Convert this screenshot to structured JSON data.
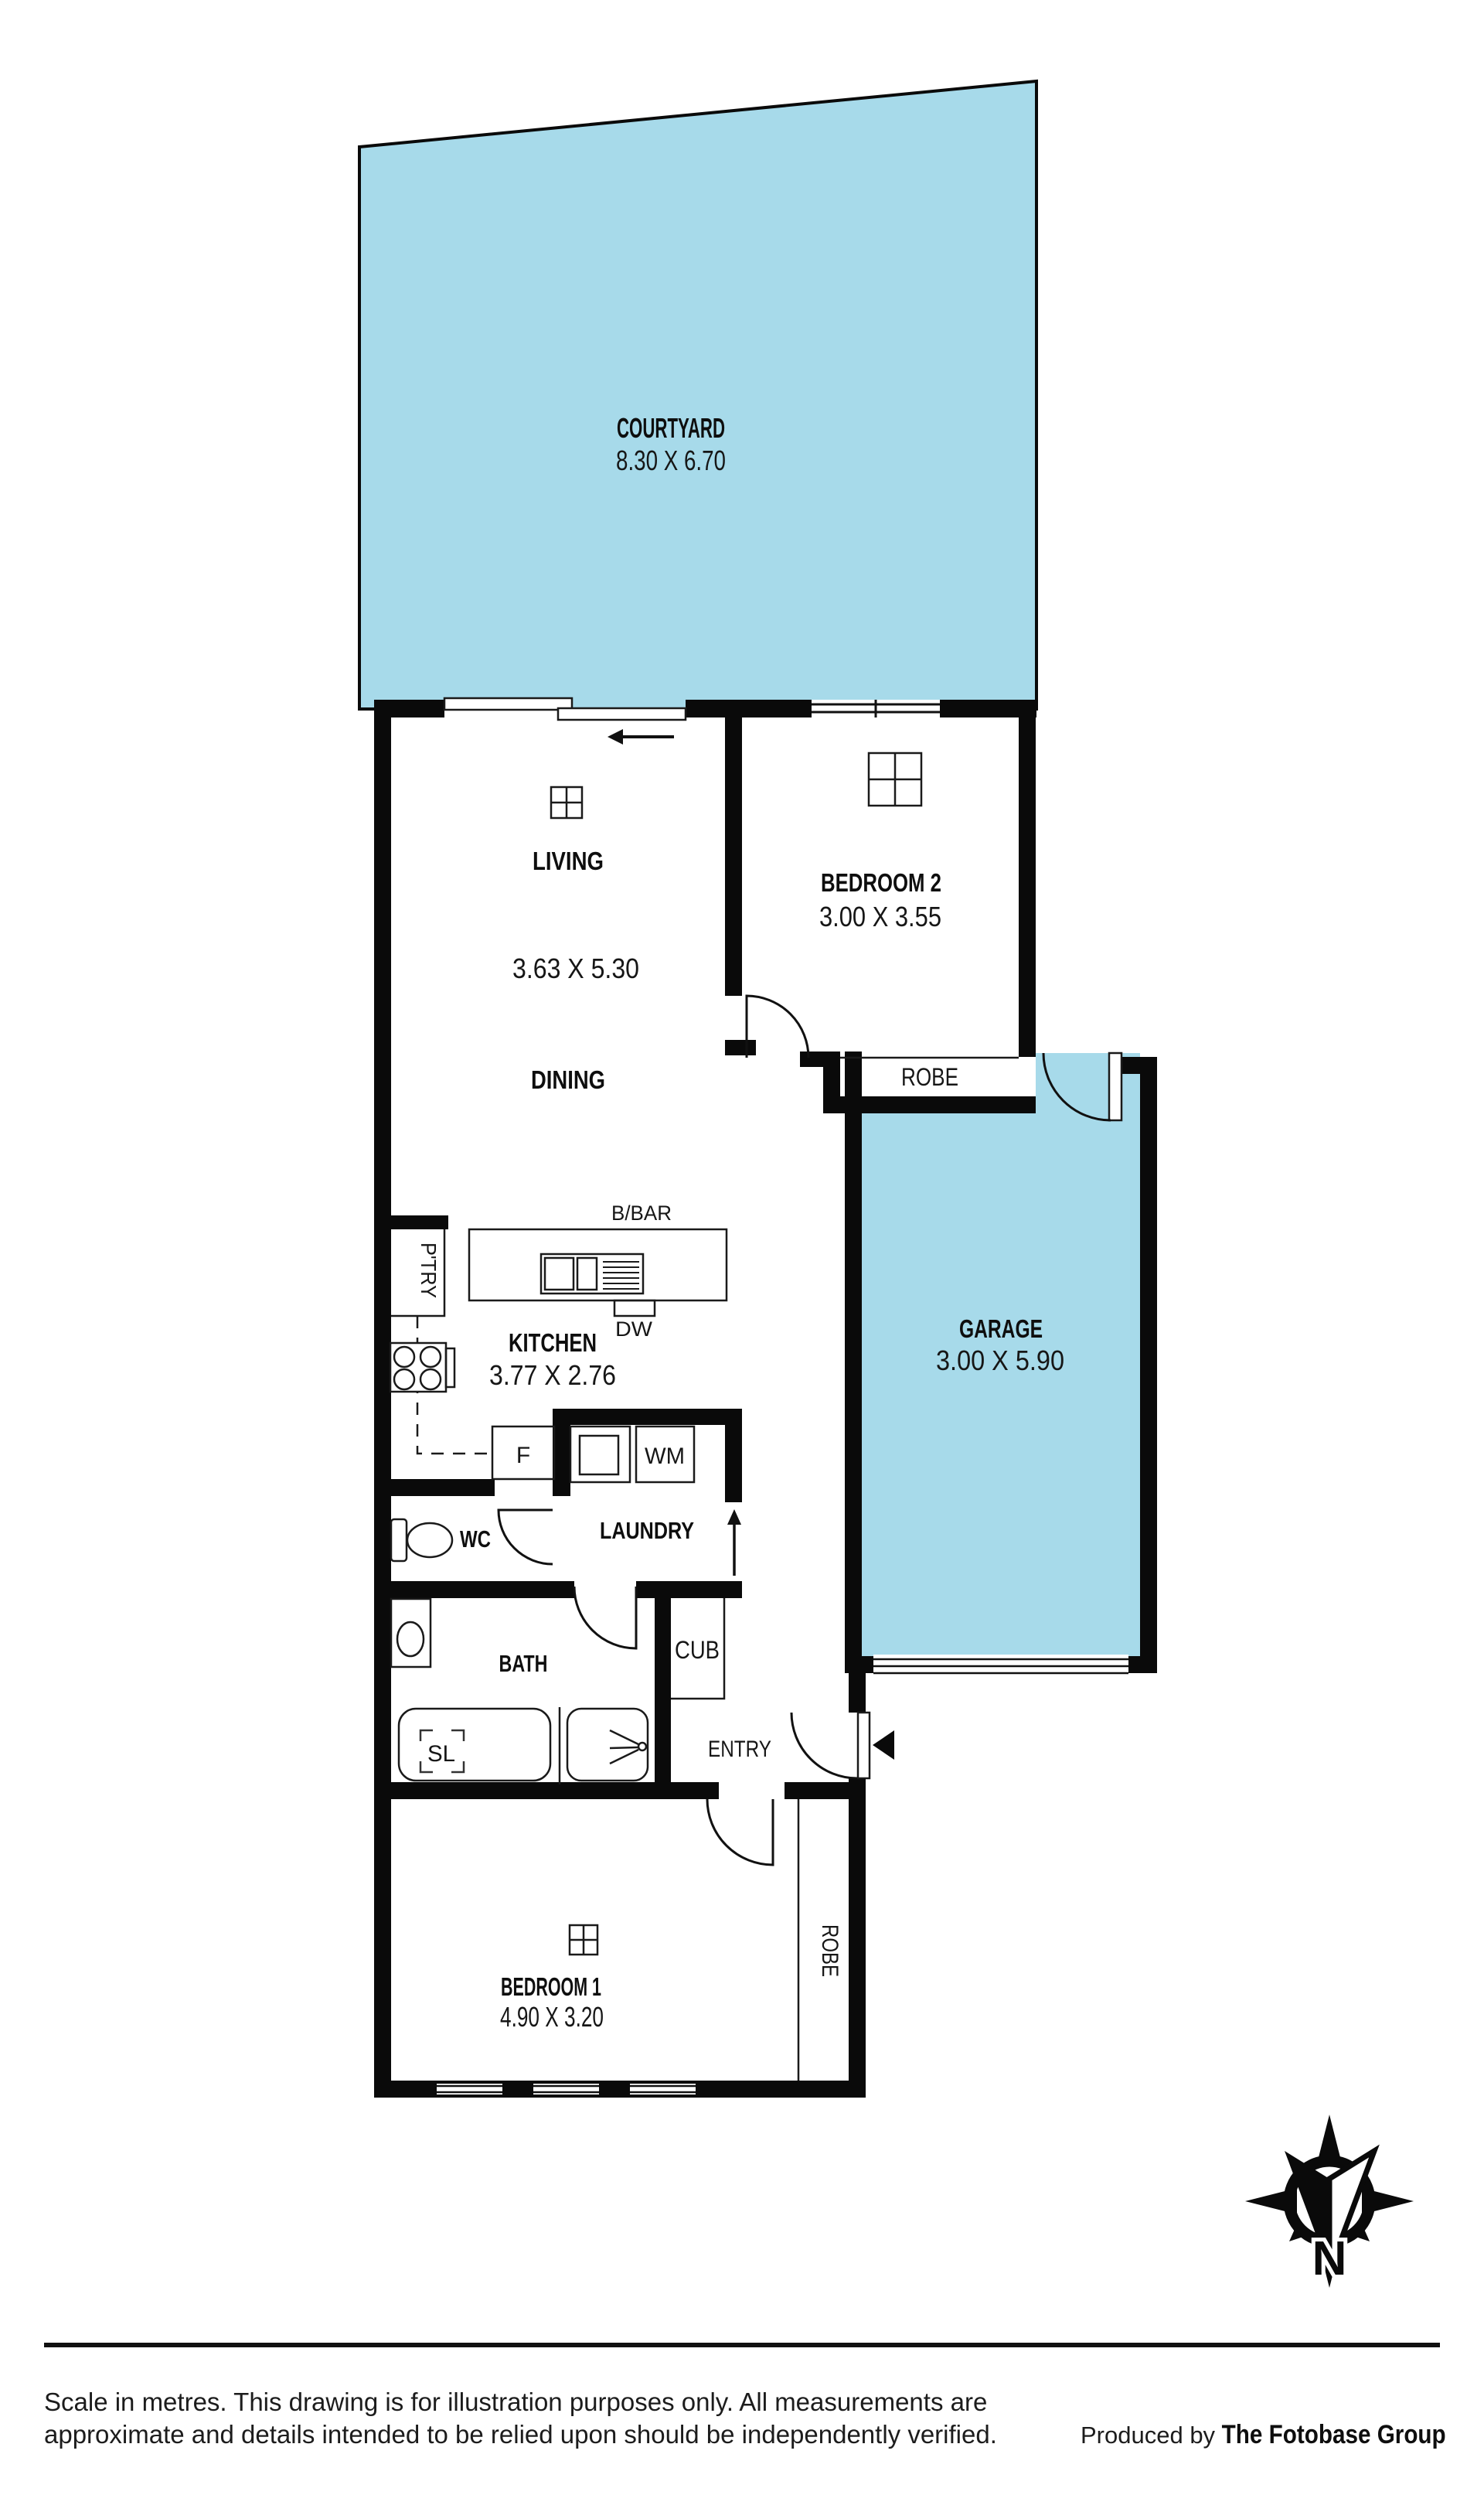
{
  "colors": {
    "highlight": "#a7daea",
    "wall": "#0a0a0a"
  },
  "rooms": {
    "courtyard": {
      "name": "COURTYARD",
      "dims": "8.30 X 6.70"
    },
    "living": {
      "name": "LIVING",
      "dims": "3.63 X 5.30"
    },
    "dining": {
      "name": "DINING"
    },
    "bedroom2": {
      "name": "BEDROOM 2",
      "dims": "3.00 X 3.55"
    },
    "garage": {
      "name": "GARAGE",
      "dims": "3.00 X 5.90"
    },
    "kitchen": {
      "name": "KITCHEN",
      "dims": "3.77 X 2.76"
    },
    "laundry": {
      "name": "LAUNDRY"
    },
    "wc": {
      "name": "WC"
    },
    "bath": {
      "name": "BATH"
    },
    "entry": {
      "name": "ENTRY"
    },
    "bedroom1": {
      "name": "BEDROOM 1",
      "dims": "4.90 X 3.20"
    }
  },
  "fixtures": {
    "robe_bed2": "ROBE",
    "robe_bed1": "ROBE",
    "pantry": "P'TRY",
    "breakfast_bar": "B/BAR",
    "dishwasher": "DW",
    "fridge": "F",
    "washing_machine": "WM",
    "cupboard": "CUB",
    "skylight": "SL"
  },
  "compass": {
    "north_label": "N"
  },
  "footer": {
    "disclaimer_line1": "Scale in metres. This drawing is for illustration purposes only. All measurements are",
    "disclaimer_line2": "approximate and details intended to be relied upon should be independently verified.",
    "credit_prefix": "Produced by ",
    "credit_name": "The Fotobase Group"
  }
}
